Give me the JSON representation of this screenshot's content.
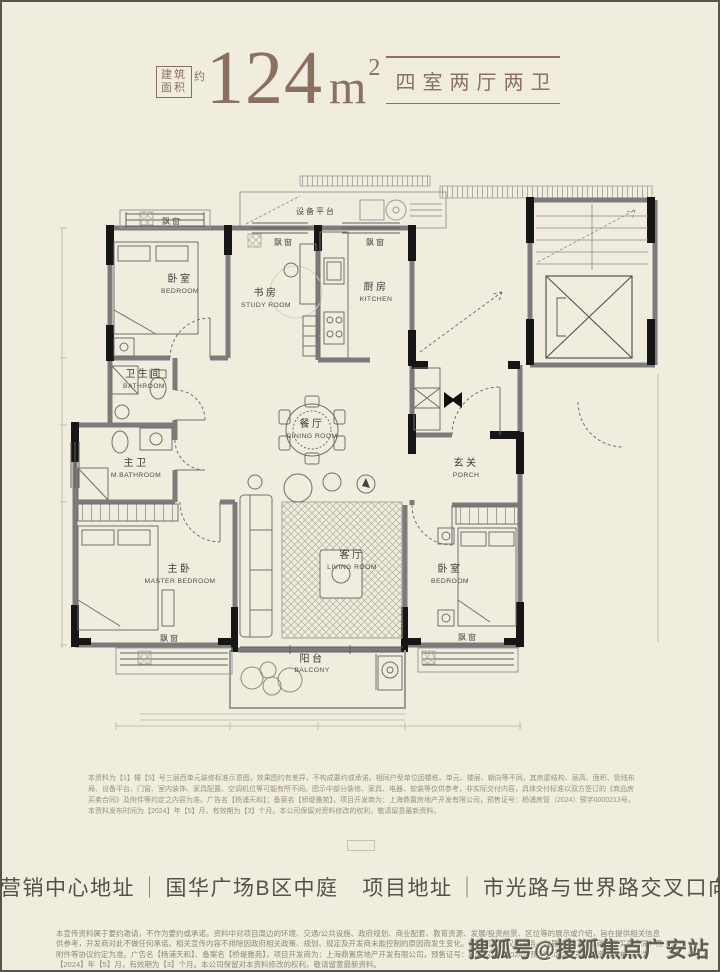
{
  "colors": {
    "accent": "#8b7060",
    "background": "#f0edde",
    "wall_dark": "#161616",
    "ink": "#3c3c3c"
  },
  "header": {
    "area_box_line1": "建筑",
    "area_box_line2": "面积",
    "approx": "约",
    "area_value": "124",
    "area_unit": "m",
    "area_sup": "2",
    "layout_type": "四室两厅两卫"
  },
  "floorplan": {
    "rooms": [
      {
        "cn": "卧室",
        "en": "BEDROOM"
      },
      {
        "cn": "书房",
        "en": "STUDY ROOM"
      },
      {
        "cn": "厨房",
        "en": "KITCHEN"
      },
      {
        "cn": "卫生间",
        "en": "BATHROOM"
      },
      {
        "cn": "主卫",
        "en": "M.BATHROOM"
      },
      {
        "cn": "餐厅",
        "en": "DINING ROOM"
      },
      {
        "cn": "主卧",
        "en": "MASTER BEDROOM"
      },
      {
        "cn": "客厅",
        "en": "LIVING ROOM"
      },
      {
        "cn": "玄关",
        "en": "PORCH"
      },
      {
        "cn": "卧室",
        "en": "BEDROOM"
      },
      {
        "cn": "阳台",
        "en": "BALCONY"
      }
    ],
    "labels": {
      "bay_window": "飘窗",
      "equipment_platform": "设备平台"
    }
  },
  "disclaimer_top": "本资料为【1】幢【5】号三层西单元装修标准示意图，效果图约有差异，不构成要约或承诺。相同户型单位因楼栋、单元、楼层、朝向等不同，其房屋结构、层高、面积、管线布局、设备平台、门窗、室内装饰、家具配置、空调机位等可能有所不同。图示中部分装修、家具、电器、软装等仅供参考，非实际交付内容，具体交付标准以双方签订的《商品房买卖合同》及附件等约定之内容为准。广告名【杨浦天和】；备案名【桥堤雅苑】，项目开发商为：上海鼎置房地产开发有限公司，预售证号：杨浦房管（2024）预字0000213号。本资料发布时间为【2024】年【5】月，有效期为【3】个月。本公司保留对资料修改的权利，敬请留意最新资料。",
  "address_bar": {
    "items": [
      {
        "label": "营销中心地址",
        "value": "国华广场B区中庭"
      },
      {
        "label": "项目地址",
        "value": "市光路与世界路交叉口向西200米"
      }
    ],
    "separator": "｜"
  },
  "disclaimer_bottom": "本宣传资料属于要约邀请，不作为要约或承诺。资料中对项目周边的环境、交通/公共设施、政府规划、商业配套、教育资源、发展/投资前景、区位等的展示或介绍，旨在提供相关信息供参考，开发商对此不做任何承诺。相关宣传内容不排除因政府相关政策、规划、规定及开发商未能控制的原因而发生变化。买卖双方的权利义务，以届时签订之《商品房买卖合同》及附件等协议约定为准。广告名【杨浦天和】、备案名【桥堤雅苑】，项目开发商为：上海鼎置房地产开发有限公司，预售证号：杨浦房管（2024）预字0000213号。本资料发布时间为【2024】年【5】月，有效期为【3】个月。本公司保留对本资料修改的权利，敬请留意最新资料。",
  "watermark": "搜狐号@搜狐焦点广安站"
}
